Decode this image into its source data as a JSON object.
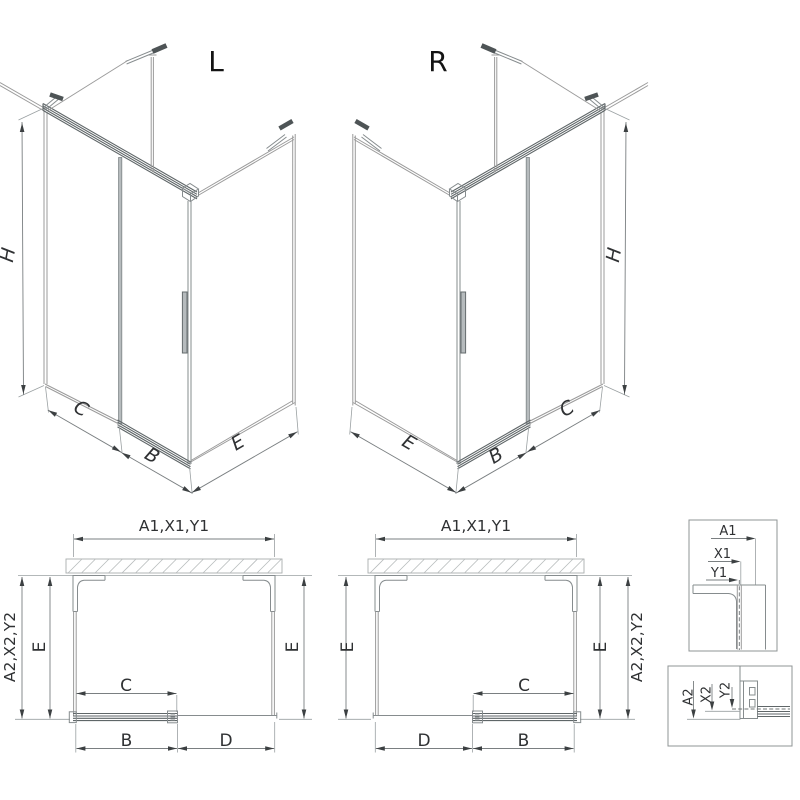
{
  "iso_left": {
    "title": "L",
    "dim_height": "H",
    "dim_c": "C",
    "dim_b": "B",
    "dim_e": "E"
  },
  "iso_right": {
    "title": "R",
    "dim_height": "H",
    "dim_e": "E",
    "dim_b": "B",
    "dim_c": "C"
  },
  "plan_left": {
    "dim_top": "A1,X1,Y1",
    "dim_left_outer": "A2,X2,Y2",
    "dim_left_inner": "E",
    "dim_right": "E",
    "dim_c": "C",
    "dim_b": "B",
    "dim_d": "D"
  },
  "plan_right": {
    "dim_top": "A1,X1,Y1",
    "dim_left": "E",
    "dim_right_inner": "E",
    "dim_right_outer": "A2,X2,Y2",
    "dim_c": "C",
    "dim_d": "D",
    "dim_b": "B"
  },
  "detail_top": {
    "dim_a1": "A1",
    "dim_x1": "X1",
    "dim_y1": "Y1"
  },
  "detail_bottom": {
    "dim_a2": "A2",
    "dim_x2": "X2",
    "dim_y2": "Y2"
  },
  "colors": {
    "thin_line": "#9b9b9b",
    "frame_line": "#868c8e",
    "rail_line": "#5f6668",
    "dimension_line": "#7a7f81",
    "arrow": "#3c4042",
    "text": "#2f3133",
    "title_text": "#141414",
    "hatch": "#b7bbbc",
    "background": "#ffffff"
  }
}
